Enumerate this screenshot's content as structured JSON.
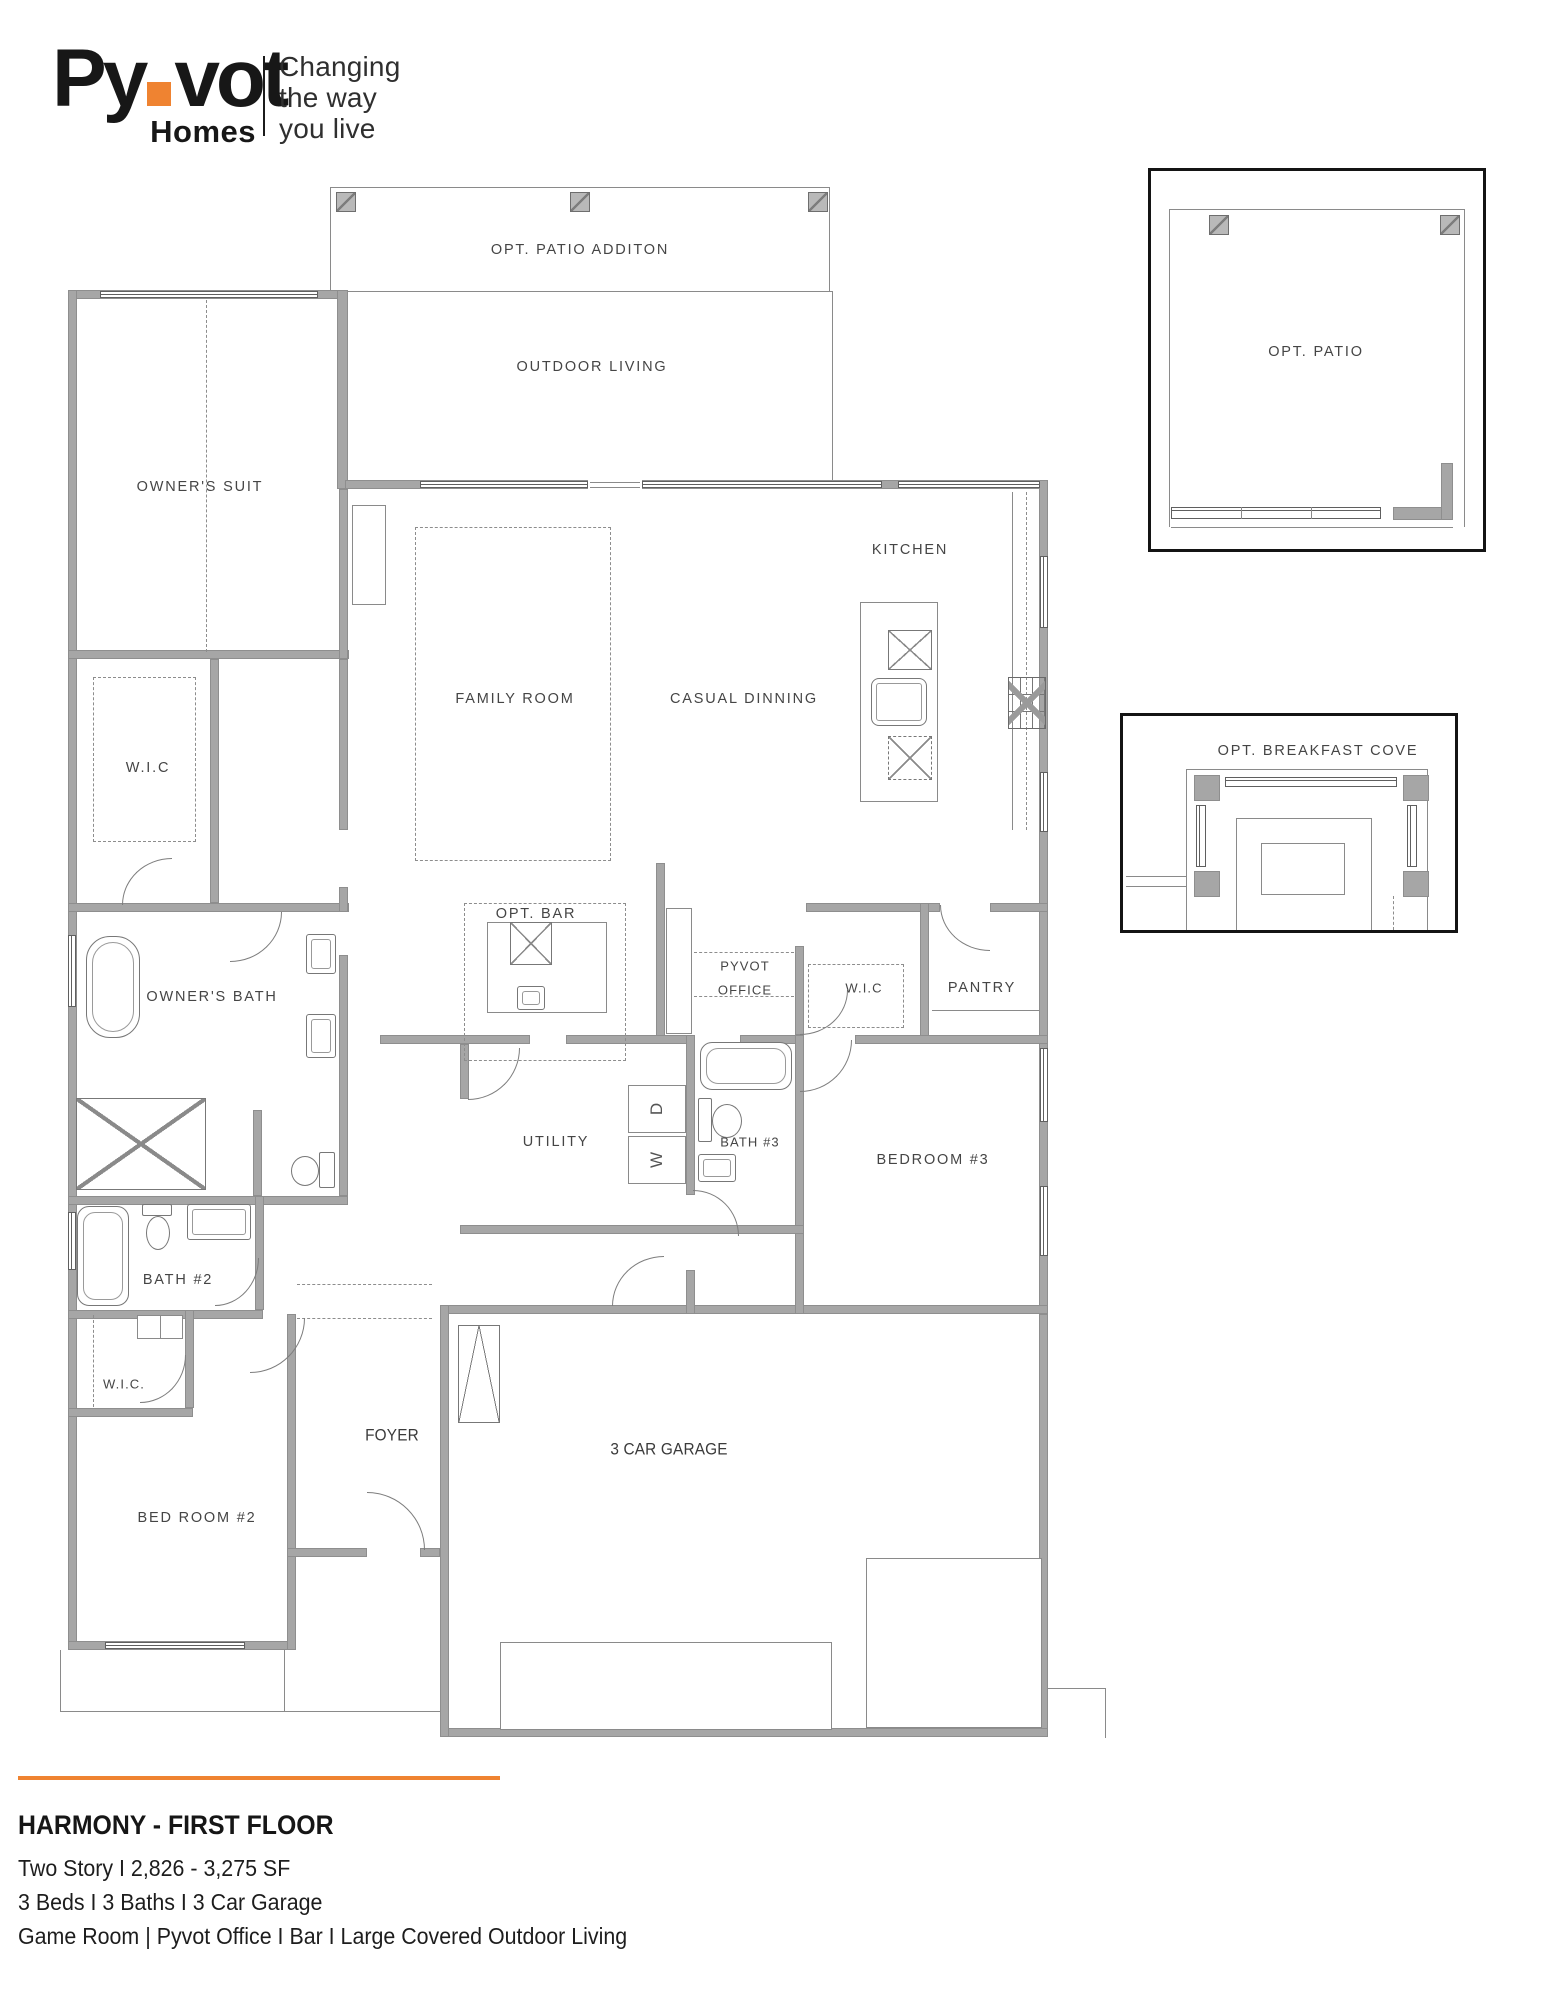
{
  "colors": {
    "accent": "#EF8331",
    "wall_gray": "#a6a6a6",
    "ink": "#171717",
    "label_gray": "#454545"
  },
  "logo": {
    "brand_part1": "Py",
    "brand_part2": "vot",
    "brand_sub": "Homes",
    "tagline_line1": "Changing",
    "tagline_line2": "the way",
    "tagline_line3": "you live"
  },
  "plan": {
    "rooms": [
      {
        "label": "OPT. PATIO ADDITON"
      },
      {
        "label": "OUTDOOR LIVING"
      },
      {
        "label": "OWNER'S SUIT"
      },
      {
        "label": "KITCHEN"
      },
      {
        "label": "FAMILY ROOM"
      },
      {
        "label": "CASUAL DINNING"
      },
      {
        "label": "W.I.C"
      },
      {
        "label": "OWNER'S BATH"
      },
      {
        "label": "OPT. BAR"
      },
      {
        "label": "PYVOT"
      },
      {
        "label": "OFFICE"
      },
      {
        "label": "W.I.C"
      },
      {
        "label": "PANTRY"
      },
      {
        "label": "UTILITY"
      },
      {
        "label": "BATH #3"
      },
      {
        "label": "BEDROOM #3"
      },
      {
        "label": "BATH #2"
      },
      {
        "label": "W.I.C."
      },
      {
        "label": "FOYER"
      },
      {
        "label": "BED ROOM #2"
      },
      {
        "label": "3 CAR GARAGE"
      }
    ],
    "utility": {
      "washer": "W",
      "dryer": "D"
    },
    "insets": {
      "patio": {
        "label": "OPT. PATIO"
      },
      "breakfast": {
        "label": "OPT. BREAKFAST COVE"
      }
    }
  },
  "footer": {
    "title": "HARMONY - FIRST FLOOR",
    "line1": "Two Story I 2,826 - 3,275 SF",
    "line2": "3 Beds I 3 Baths I 3 Car Garage",
    "line3": "Game Room | Pyvot Office I Bar I Large Covered Outdoor Living"
  }
}
